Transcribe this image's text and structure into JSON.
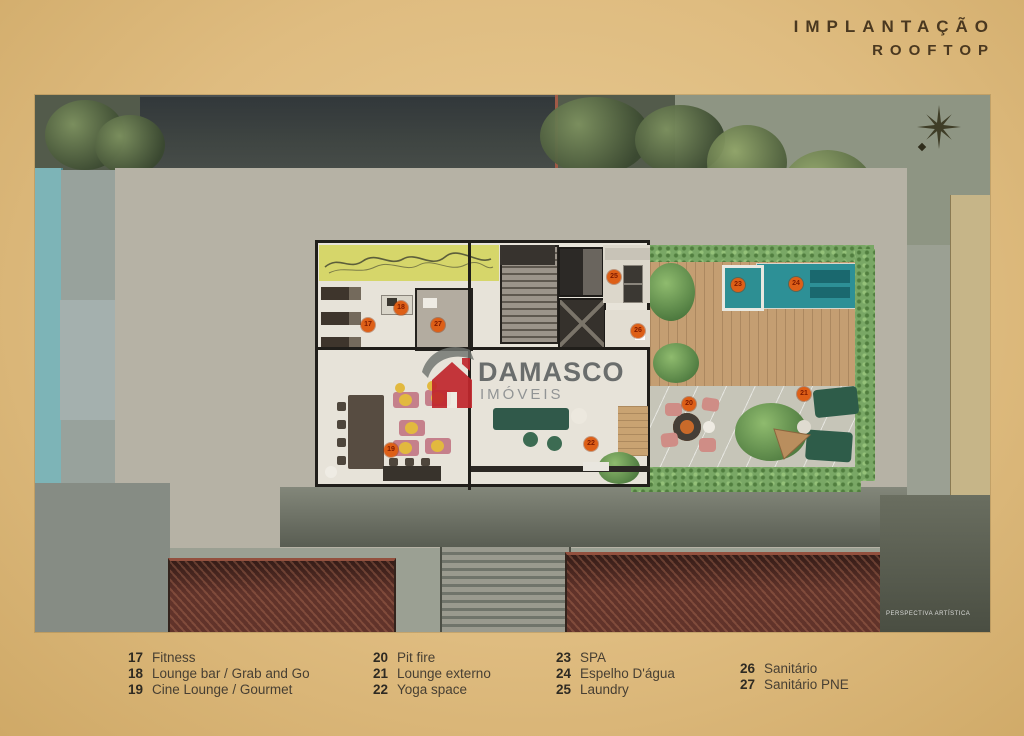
{
  "header": {
    "title_line1": "IMPLANTAÇÃO",
    "title_line2": "ROOFTOP"
  },
  "watermark": {
    "brand": "DAMASCO",
    "subtitle": "IMÓVEIS",
    "icon": "house-logo-icon"
  },
  "plan": {
    "note": "PERSPECTIVA ARTÍSTICA",
    "compass": "compass-rose-icon"
  },
  "amenities": [
    {
      "num": "17",
      "label": "Fitness"
    },
    {
      "num": "18",
      "label": "Lounge bar / Grab and Go"
    },
    {
      "num": "19",
      "label": "Cine Lounge / Gourmet"
    },
    {
      "num": "20",
      "label": "Pit fire"
    },
    {
      "num": "21",
      "label": "Lounge externo"
    },
    {
      "num": "22",
      "label": "Yoga space"
    },
    {
      "num": "23",
      "label": "SPA"
    },
    {
      "num": "24",
      "label": "Espelho D'água"
    },
    {
      "num": "25",
      "label": "Laundry"
    },
    {
      "num": "26",
      "label": "Sanitário"
    },
    {
      "num": "27",
      "label": "Sanitário PNE"
    }
  ],
  "colors": {
    "background": "#dfbc80",
    "title_text": "#4a3820",
    "marker": "#dd5f17",
    "pool_water": "#2d9096",
    "fitness_accent_wall": "#d6d66a",
    "roof_tiles": "#61332a",
    "hedge_green": "#79a765",
    "brand_red": "#c1272d",
    "legend_text": "#473f33"
  }
}
